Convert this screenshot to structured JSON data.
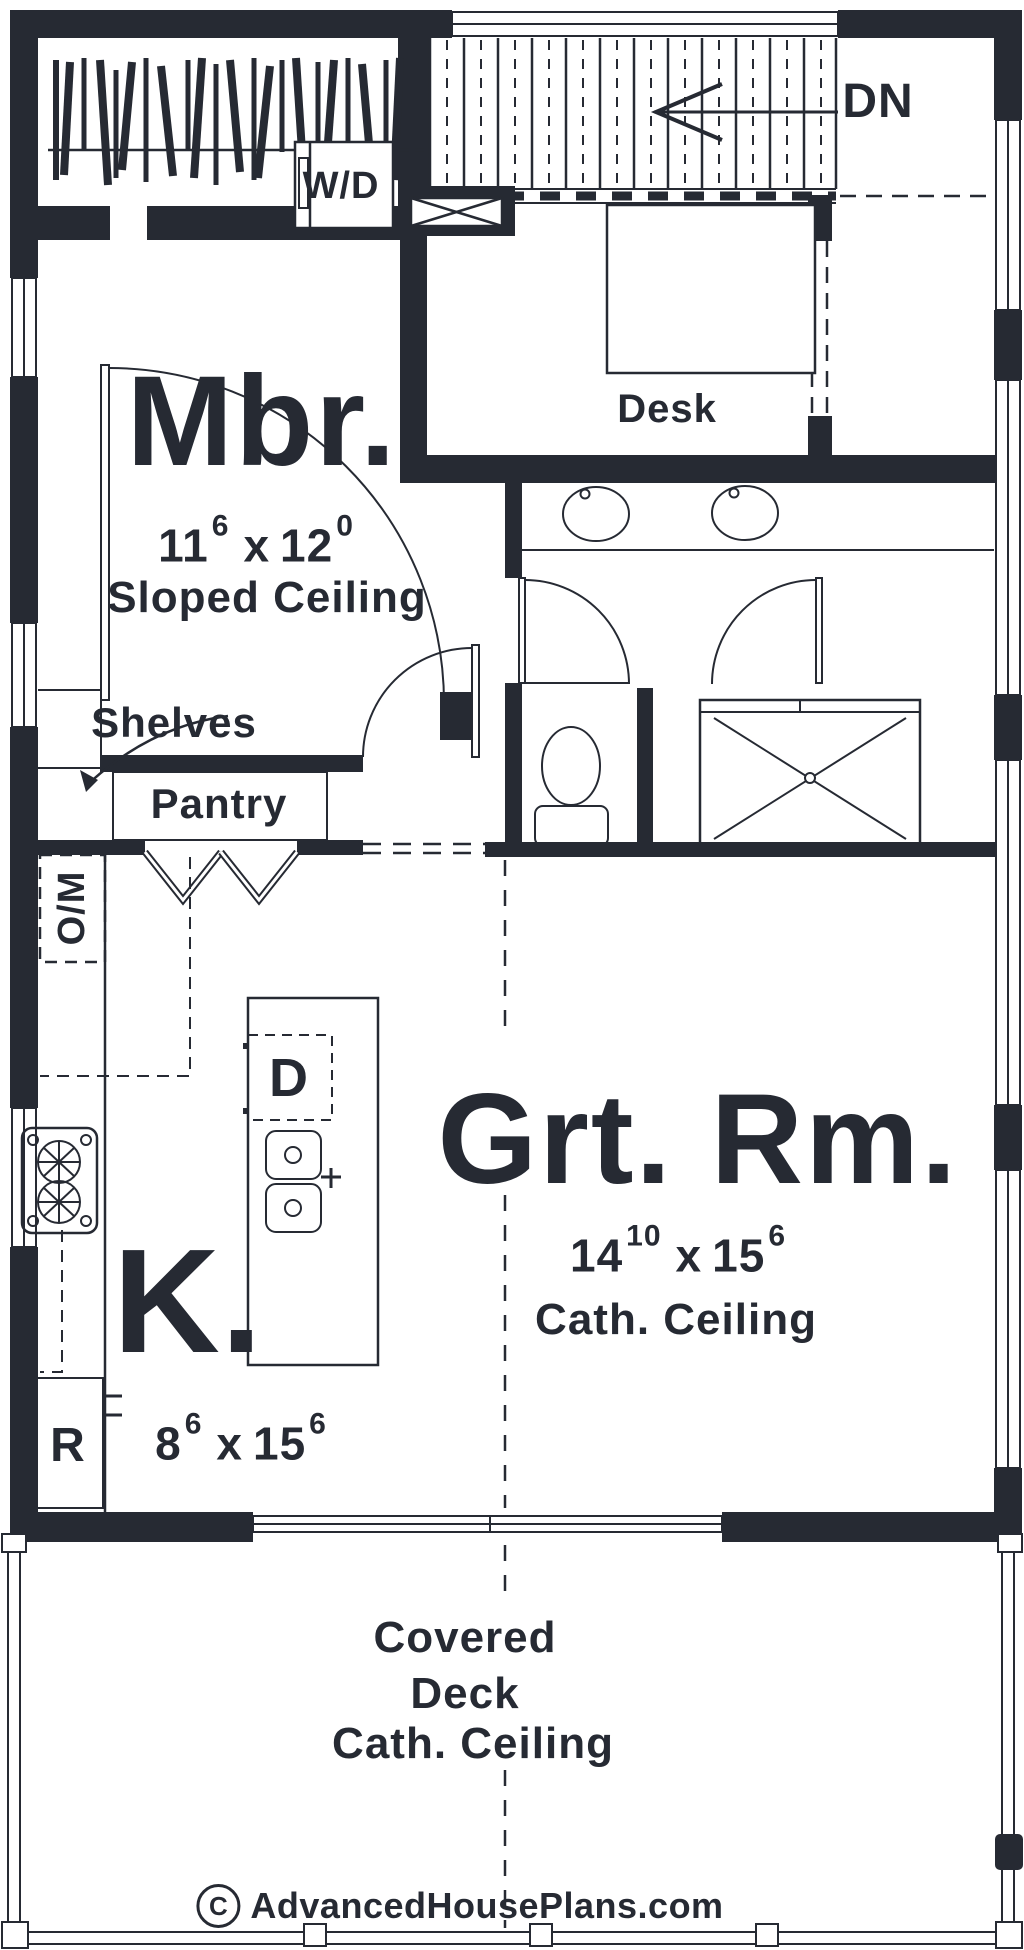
{
  "colors": {
    "ink": "#262a33",
    "background": "#ffffff"
  },
  "rooms": {
    "master": {
      "name": "Mbr.",
      "dim_a": "11",
      "dim_a_sup": "6",
      "times": "x",
      "dim_b": "12",
      "dim_b_sup": "0",
      "ceiling": "Sloped Ceiling"
    },
    "great_room": {
      "name": "Grt. Rm.",
      "dim_a": "14",
      "dim_a_sup": "10",
      "times": "x",
      "dim_b": "15",
      "dim_b_sup": "6",
      "ceiling": "Cath. Ceiling"
    },
    "kitchen": {
      "name": "K.",
      "dim_a": "8",
      "dim_a_sup": "6",
      "times": "x",
      "dim_b": "15",
      "dim_b_sup": "6"
    },
    "deck": {
      "line1": "Covered",
      "line2": "Deck",
      "line3": "Cath. Ceiling"
    }
  },
  "labels": {
    "washer_dryer": "W/D",
    "down": "DN",
    "desk": "Desk",
    "shelves": "Shelves",
    "pantry": "Pantry",
    "oven_microwave": "O/M",
    "dishwasher": "D",
    "refrigerator": "R"
  },
  "footer": {
    "copyright_symbol": "C",
    "site": "AdvancedHousePlans.com"
  }
}
